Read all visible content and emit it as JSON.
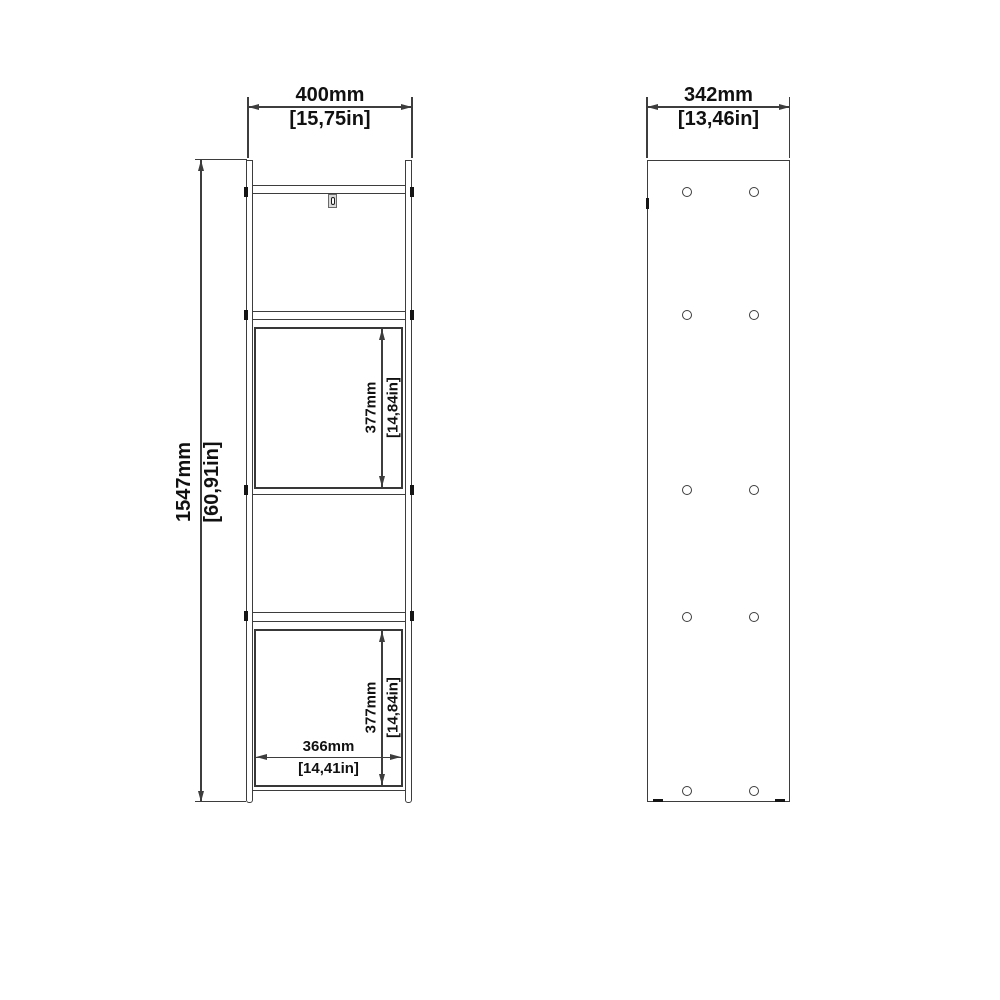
{
  "colors": {
    "line": "#3d3d3d",
    "text": "#111111",
    "background": "#ffffff"
  },
  "front_view": {
    "width": {
      "mm": "400mm",
      "inch": "[15,75in]"
    },
    "height": {
      "mm": "1547mm",
      "inch": "[60,91in]"
    },
    "upper_compartment_height": {
      "mm": "377mm",
      "inch": "[14,84in]"
    },
    "lower_compartment_height": {
      "mm": "377mm",
      "inch": "[14,84in]"
    },
    "inner_width": {
      "mm": "366mm",
      "inch": "[14,41in]"
    }
  },
  "side_view": {
    "depth": {
      "mm": "342mm",
      "inch": "[13,46in]"
    },
    "hole_pairs": 5
  }
}
